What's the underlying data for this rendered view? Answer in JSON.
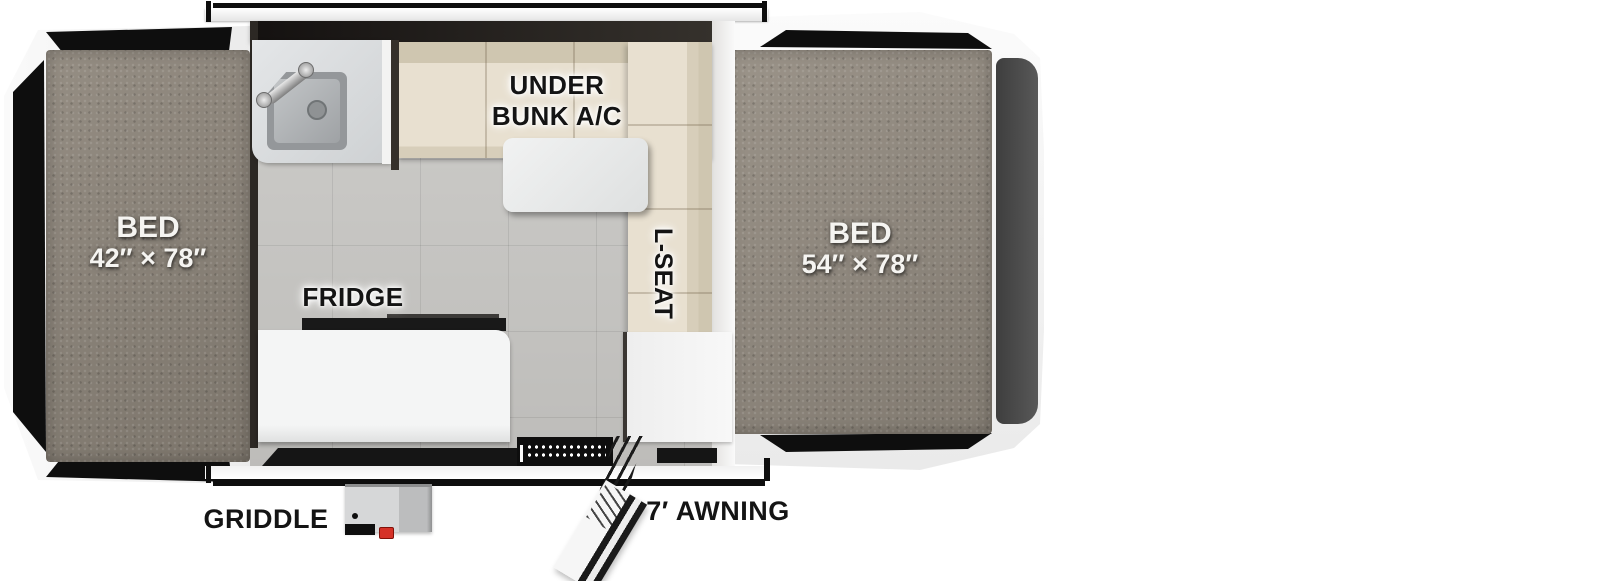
{
  "title": "Pop-up camper floorplan",
  "labels": {
    "bed_left": {
      "name": "BED",
      "size": "42″ × 78″"
    },
    "bed_right": {
      "name": "BED",
      "size": "54″ × 78″"
    },
    "under_bunk_ac_line1": "UNDER",
    "under_bunk_ac_line2": "BUNK A/C",
    "l_seat": "L-SEAT",
    "fridge": "FRIDGE",
    "griddle": "GRIDDLE",
    "awning": "7′ AWNING"
  },
  "palette": {
    "mattress_gray": "#8d857a",
    "bench_beige": "#e6decd",
    "floor_gray": "#c9c8c5",
    "body_black": "#121212",
    "end_panel_gray": "#474747",
    "griddle_knob_red": "#d53127"
  }
}
